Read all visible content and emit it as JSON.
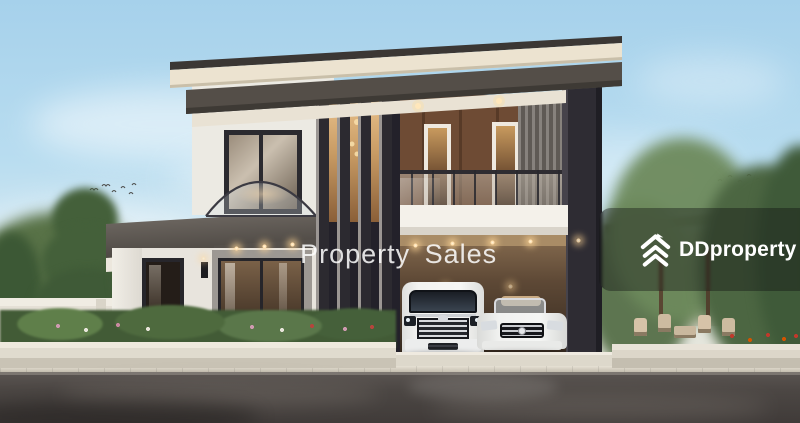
{
  "watermark": {
    "text": "Property Sales",
    "color": "#ffffff"
  },
  "brand": {
    "name": "DDproperty",
    "icon": "ddproperty-chevron-house-icon",
    "overlay_color": "rgba(12,12,16,0.38)",
    "text_color": "#ffffff"
  },
  "scene": {
    "type": "architectural-render",
    "subject": "modern two-storey detached house with carport, white MPV van and white convertible parked, landscaped gardens, wet asphalt road in foreground",
    "palette": {
      "sky_top": "#a9d3ec",
      "sky_horizon": "#d8e9ef",
      "roof_dark": "#3b3734",
      "roof_cream": "#ece3d0",
      "charcoal": "#2c2a30",
      "wood_brown": "#6e4b34",
      "wall_white": "#eceae3",
      "hedge_green": "#4e6a3e",
      "road_asphalt": "#4c4744",
      "sidewalk": "#d6d1c4",
      "warm_light": "#ffd9a0",
      "car_white": "#f2f2f0"
    }
  }
}
